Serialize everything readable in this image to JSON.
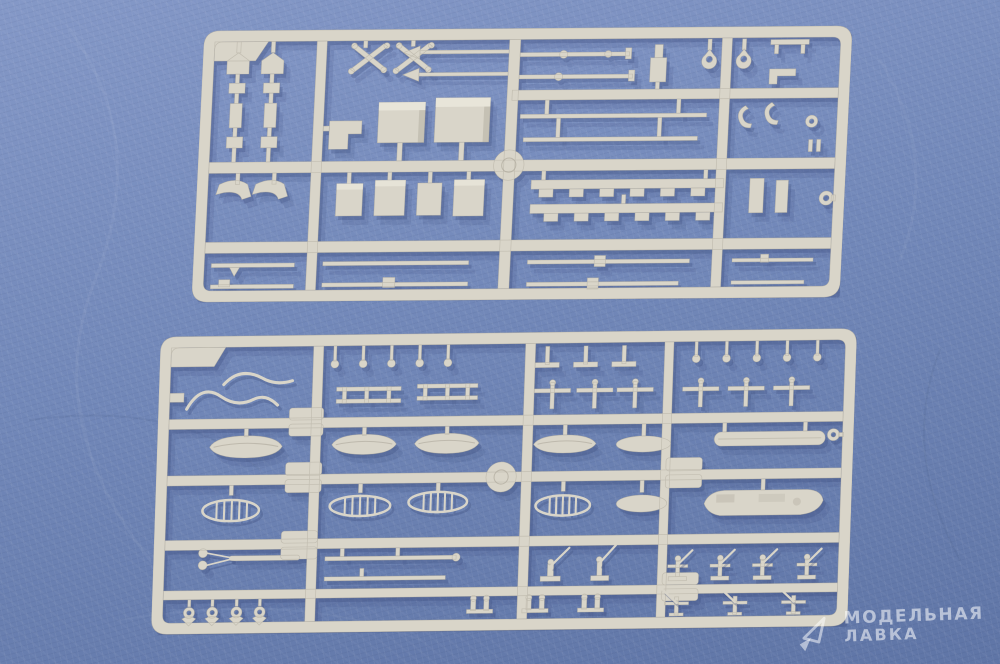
{
  "scene": {
    "description": "Photograph of two light-grey injection-moulded plastic model kit sprues (runners) with small warship detail parts, lying on a blue leather-textured surface",
    "objects": [
      {
        "name": "sprue-top",
        "type": "plastic-model-sprue",
        "parts_hint": "deckhouse boxes, funnels, crossed supports, masts with spear tips, yardarms, crenellated bulkhead strips, thin spars, davit hooks, ring fittings"
      },
      {
        "name": "sprue-bottom",
        "type": "plastic-model-sprue",
        "parts_hint": "upturned ship's boats, open whaleboats with thwarts, pontoon float, motor launch, davits, bollard posts, wishbone boom with ball ends, paravanes, twin bitts, pedestal AA guns"
      }
    ]
  },
  "watermark": {
    "logo": "model-lavka-logo",
    "line1": "МОДЕЛЬНАЯ",
    "line2": "ЛАВКА"
  },
  "colors": {
    "background": "#7288b9",
    "background_light": "#8498c7",
    "background_dark": "#5f75a6",
    "plastic": "#d9d5c9",
    "plastic_light": "#ebe8dd",
    "plastic_dark": "#a8a396",
    "shadow": "#3d4e7e",
    "watermark": "rgba(255,255,255,0.55)"
  }
}
